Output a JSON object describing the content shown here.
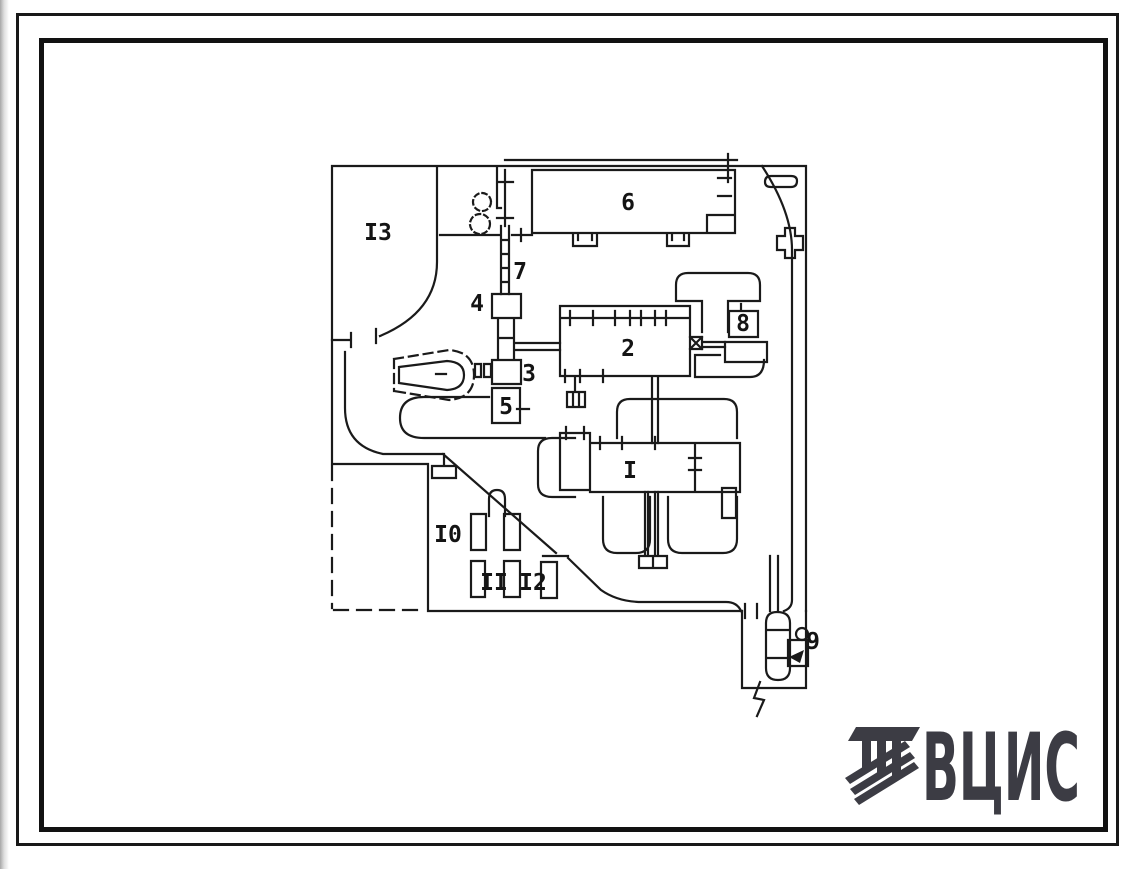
{
  "sheet": {
    "background": "#ffffff",
    "ink_color": "#1a1a1a"
  },
  "plan": {
    "description": "general site plan linework with numbered buildings",
    "labels": [
      {
        "building": "1",
        "text": "I"
      },
      {
        "building": "2",
        "text": "2"
      },
      {
        "building": "3",
        "text": "3"
      },
      {
        "building": "4",
        "text": "4"
      },
      {
        "building": "5",
        "text": "5"
      },
      {
        "building": "6",
        "text": "6"
      },
      {
        "building": "7",
        "text": "7"
      },
      {
        "building": "8",
        "text": "8"
      },
      {
        "building": "9",
        "text": "9"
      },
      {
        "building": "10",
        "text": "I0"
      },
      {
        "building": "11",
        "text": "II"
      },
      {
        "building": "12",
        "text": "I2"
      },
      {
        "building": "13",
        "text": "I3"
      }
    ]
  },
  "logo": {
    "text": "ВЦИС",
    "color": "#3c3c44"
  }
}
